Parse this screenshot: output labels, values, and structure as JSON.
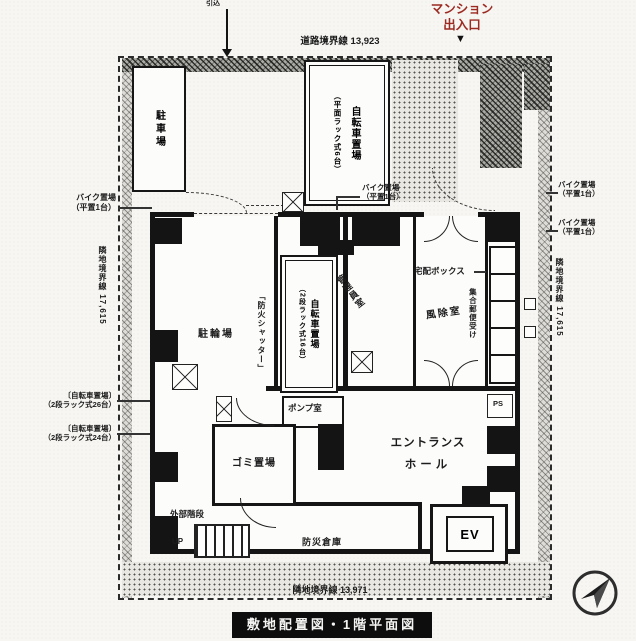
{
  "title_bar": {
    "text": "敷地配置図・1階平面図"
  },
  "boundary_labels": {
    "road_top": "道路境界線 13,923",
    "neighbor_left": "隣地境界線 17,615",
    "neighbor_right": "隣地境界線 17,615",
    "neighbor_bottom": "隣地境界線 13,971"
  },
  "entrance_sign": {
    "line1": "マンション",
    "line2": "出入口",
    "arrow": "▼"
  },
  "service_drop_label": "引込",
  "rooms": {
    "parking": "駐車場",
    "bicycle_flat": {
      "line1": "自転車置場",
      "line2": "（平面ラック式6台）"
    },
    "bicycle_rack": {
      "line1": "自転車置場",
      "line2": "（2段ラック式16台）"
    },
    "bike_yard": "駐輪場",
    "fire_shutter": "「防火シャッター」",
    "manager_room": "管理員室",
    "windbreak_room": "風除室",
    "delivery_box": "宅配ボックス",
    "mailboxes": "集合郵便受け",
    "pump_room": "ポンプ室",
    "garbage_room": "ゴミ置場",
    "entrance_hall": {
      "line1": "エントランス",
      "line2": "ホール"
    },
    "pipe_space": "PS",
    "elevator": "EV",
    "disaster_storage": "防災倉庫",
    "external_stairs": "外部階段",
    "stairs_up": "UP"
  },
  "bike_parking_label": {
    "line1": "バイク置場",
    "line2": "（平置1台）"
  },
  "bicycle_rack_side_labels": [
    {
      "line1": "〔自転車置場〕",
      "line2": "（2段ラック式26台）"
    },
    {
      "line1": "〔自転車置場〕",
      "line2": "（2段ラック式24台）"
    }
  ],
  "colors": {
    "entrance_sign": "#9c2a22",
    "line": "#141414",
    "paper": "#f7f6f3"
  }
}
